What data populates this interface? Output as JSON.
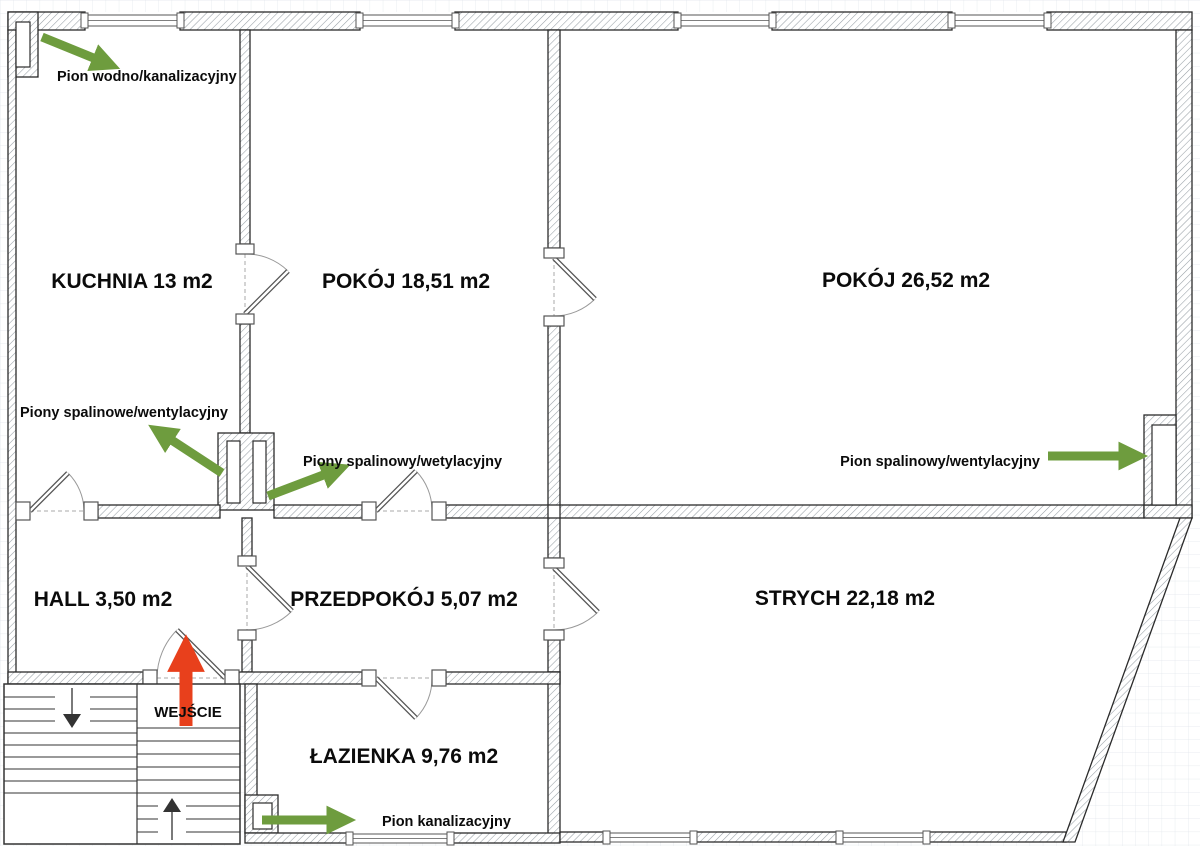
{
  "floorplan": {
    "rooms": [
      {
        "id": "kuchnia",
        "label": "KUCHNIA 13 m2"
      },
      {
        "id": "pokoj-1",
        "label": "POKÓJ 18,51 m2"
      },
      {
        "id": "pokoj-2",
        "label": "POKÓJ 26,52 m2"
      },
      {
        "id": "hall",
        "label": "HALL 3,50 m2"
      },
      {
        "id": "przedpokoj",
        "label": "PRZEDPOKÓJ 5,07 m2"
      },
      {
        "id": "strych",
        "label": "STRYCH 22,18 m2"
      },
      {
        "id": "lazienka",
        "label": "ŁAZIENKA 9,76 m2"
      }
    ],
    "annotations": [
      {
        "id": "pion-wodno",
        "label": "Pion wodno/kanalizacyjny"
      },
      {
        "id": "piony-spalinowe",
        "label": "Piony spalinowe/wentylacyjny"
      },
      {
        "id": "piony-spalinowy",
        "label": "Piony spalinowy/wetylacyjny"
      },
      {
        "id": "pion-spalinowy",
        "label": "Pion spalinowy/wentylacyjny"
      },
      {
        "id": "pion-kanalizacyjny",
        "label": "Pion kanalizacyjny"
      }
    ],
    "entrance": {
      "label": "WEJŚCIE"
    },
    "colors": {
      "annotation_arrow": "#6e9c3e",
      "entrance_arrow": "#e8401c",
      "wall_outline": "#2b2b2b",
      "hatch": "#98a0a6",
      "text": "#0b0b0b"
    }
  }
}
